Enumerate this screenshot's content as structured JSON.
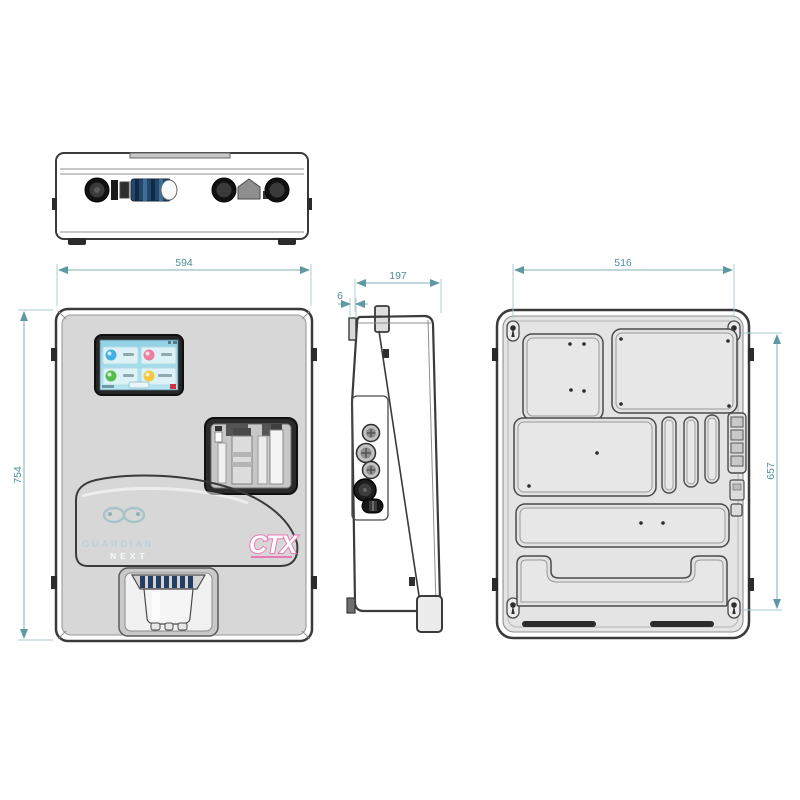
{
  "drawing": {
    "type": "technical-drawing",
    "product": {
      "brand": "CTX",
      "model_line1": "GUARDIAN",
      "model_line2": "NEXT"
    },
    "dimensions": {
      "front_width": "594",
      "front_height": "754",
      "side_depth": "197",
      "side_lip": "6",
      "back_hole_spacing_h": "516",
      "back_hole_spacing_v": "657"
    },
    "display": {
      "tiles": [
        {
          "icon": "indicator-sphere-blue",
          "color": "#45aee2"
        },
        {
          "icon": "indicator-sphere-pink",
          "color": "#ec7f9d"
        },
        {
          "icon": "indicator-sphere-green",
          "color": "#55bd4f"
        },
        {
          "icon": "indicator-sphere-yellow",
          "color": "#f2c83d"
        }
      ]
    },
    "colors": {
      "dimension_line": "#7fadb6",
      "dimension_text": "#4f8f99",
      "outline": "#3a3a3a",
      "body_fill": "#d6d6d6",
      "glass_top": "#d8edee",
      "glass_bottom": "#7db4c1",
      "screen_fill": "#a5dcec",
      "brand_pink": "#e87ab5"
    }
  }
}
